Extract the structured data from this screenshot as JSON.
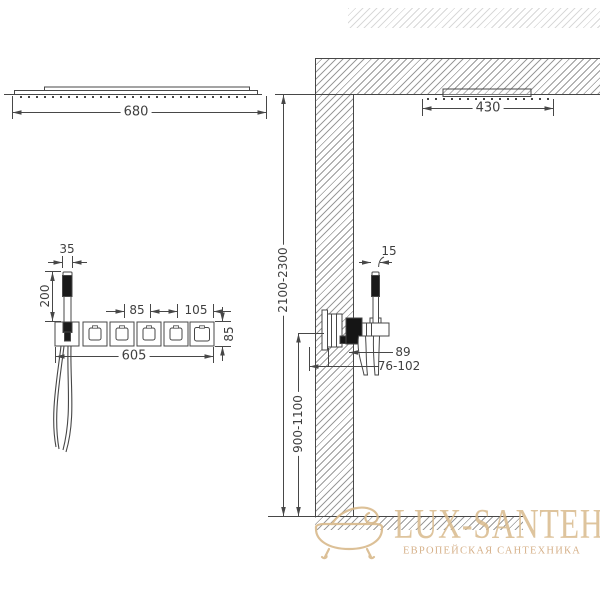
{
  "drawing": {
    "title": "Shower system installation dimension drawing",
    "dims": {
      "overhead_width": "680",
      "ceiling_shower_width": "430",
      "handshower_bracket_width": "35",
      "handshower_length": "200",
      "module_spacing": "85",
      "end_module_width": "105",
      "panel_height": "85",
      "panel_length": "605",
      "handshower_side_depth": "15",
      "valve_body_width": "89",
      "mounting_depth_range": "76-102",
      "ceiling_height_range": "2100-2300",
      "valve_height_range": "900-1100"
    }
  },
  "watermark": {
    "brand": "LUX-SANTEH",
    "tagline": "ЕВРОПЕЙСКАЯ САНТЕХНИКА"
  },
  "colors": {
    "line": "#474747",
    "hatch": "#9b9b9b",
    "watermark_accent": "#d9ba8c"
  }
}
